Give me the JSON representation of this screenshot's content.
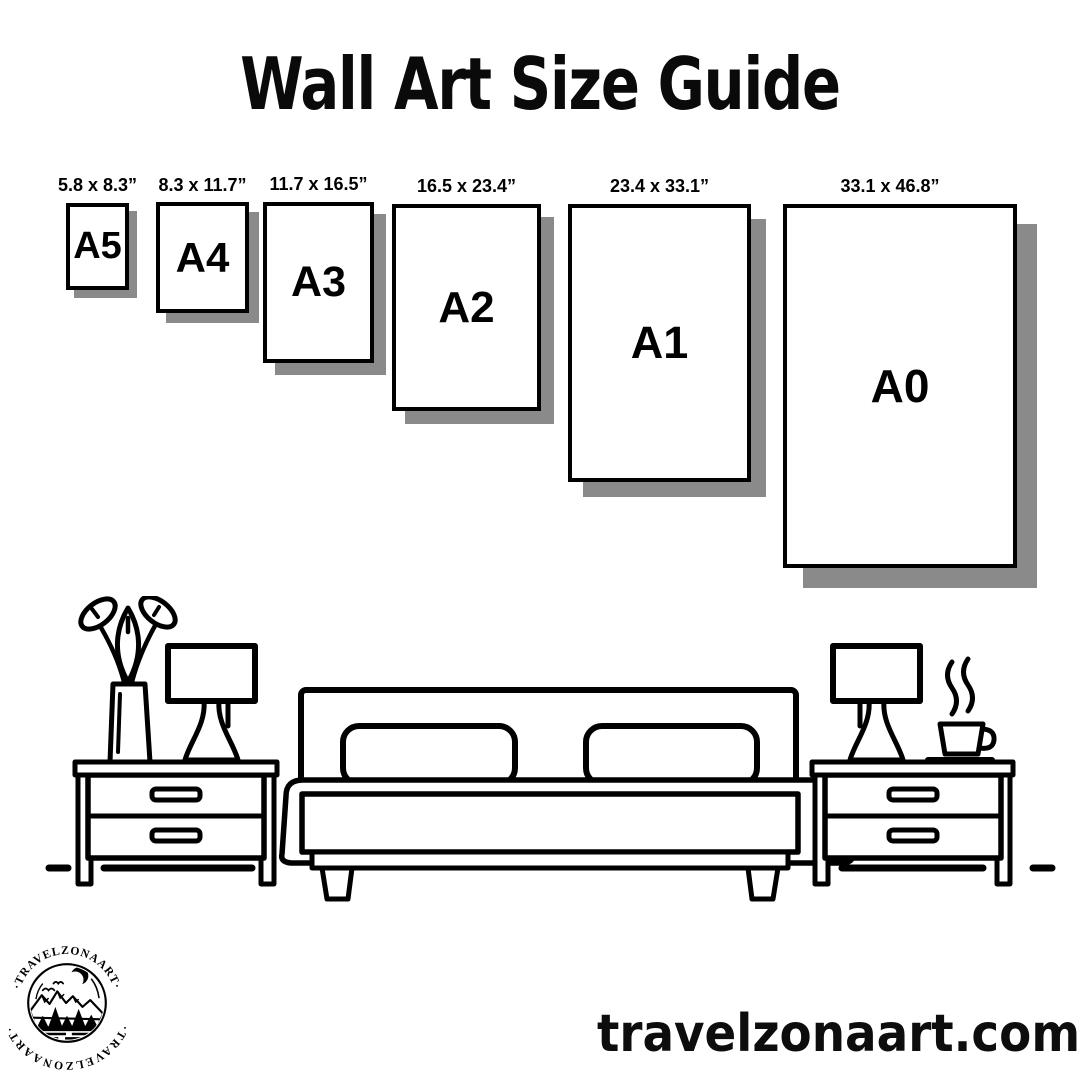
{
  "page": {
    "title": "Wall Art Size Guide",
    "website": "travelzonaart.com"
  },
  "colors": {
    "ink": "#000000",
    "background": "#ffffff",
    "box_shadow": "#8a8a8a"
  },
  "size_guide": {
    "unit": "inches",
    "sizes": [
      {
        "code": "A5",
        "label": "5.8 x 8.3”"
      },
      {
        "code": "A4",
        "label": "8.3 x 11.7”"
      },
      {
        "code": "A3",
        "label": "11.7 x 16.5”"
      },
      {
        "code": "A2",
        "label": "16.5 x 23.4”"
      },
      {
        "code": "A1",
        "label": "23.4 x 33.1”"
      },
      {
        "code": "A0",
        "label": "33.1 x 46.8”"
      }
    ]
  },
  "logo": {
    "brand": "TRAVELZONAART",
    "arc_top": "·TRAVELZONAART·",
    "arc_bottom": "·TRAVELZONAART·"
  },
  "illustration": {
    "icons": [
      "flower-vase-icon",
      "table-lamp-icon",
      "nightstand-icon",
      "double-bed-icon",
      "coffee-cup-icon",
      "floor-line"
    ]
  }
}
